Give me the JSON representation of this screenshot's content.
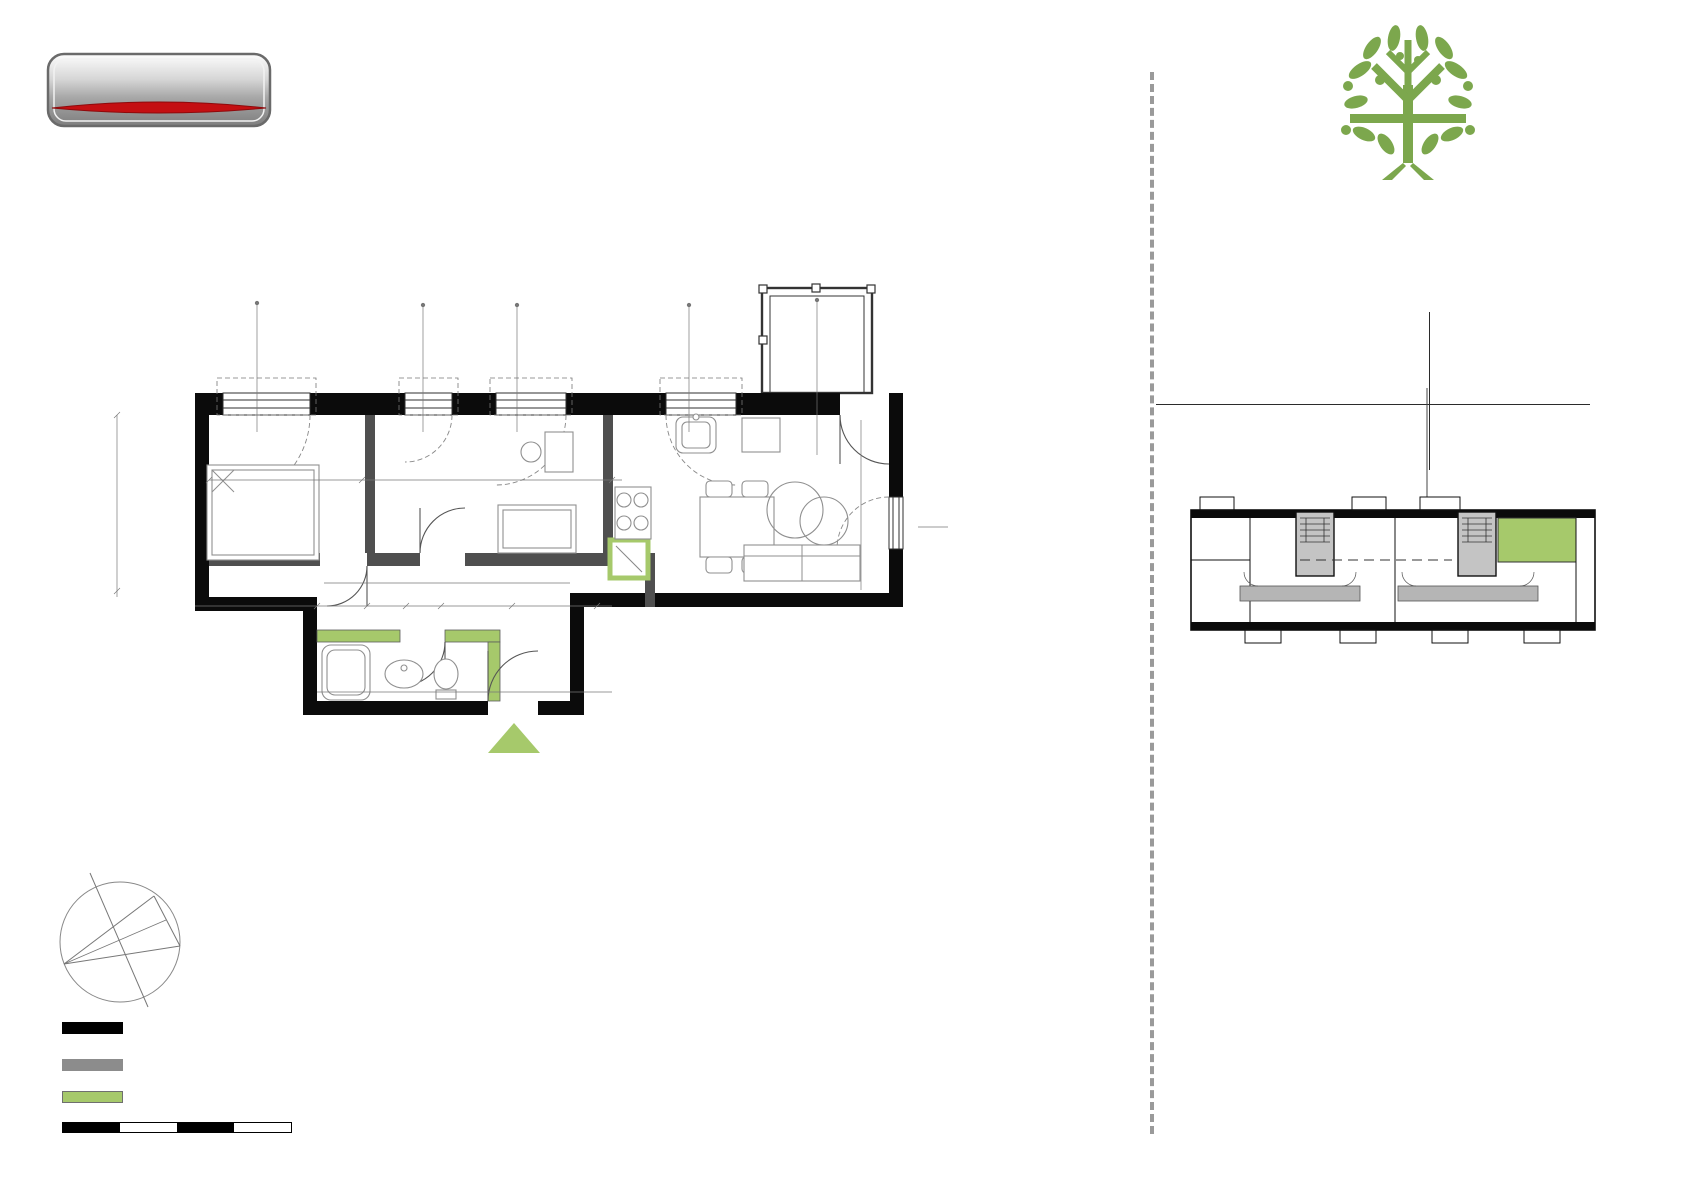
{
  "colors": {
    "green": "#7CA74D",
    "plan-green": "#A6C96B"
  },
  "developer": {
    "logo_text": "CENTRUM ZANA",
    "name": "Centrum Zana G.Turski M. Balcerek",
    "line2": "Spółka komandytowa",
    "line3": "ul. Nałęczowska 14,",
    "line4": "20-701 Lublin"
  },
  "project": {
    "name_top": "SNOPKÓW",
    "name_bottom": "PARK",
    "apartment": "MIESZKANIE NR 11",
    "building": "Budynek B10"
  },
  "details": {
    "typ_label": "TYP:",
    "typ_bold": "trzy",
    "typ_rest1": "pokojowe z",
    "typ_rest2": "aneksem kuchennym",
    "area_label": "POWIERZCHNIA:",
    "area_value": "59,34 m",
    "area_sup": "2",
    "floor_label": "KONDYGNACJA:",
    "floor_value": "piętro +2",
    "height_label": "WYSOKOŚĆ:",
    "height_value": "2,55 m"
  },
  "rooms": {
    "header": "WYKAZ POMIESZCZEŃ:",
    "unit_sup": "2",
    "items": [
      {
        "no": "1",
        "name": "przedpokój",
        "area": "9,02 m"
      },
      {
        "no": "2",
        "name": "salon z aneksem",
        "area": "22,86 m"
      },
      {
        "no": "3",
        "name": "pokój",
        "area": "10,44 m"
      },
      {
        "no": "4",
        "name": "pokój",
        "area": "10,85 m"
      },
      {
        "no": "5",
        "name": "łazienka",
        "area": "5,19 m"
      }
    ],
    "extra": [
      {
        "no": "",
        "name": "balkon",
        "area": "2,76 m"
      }
    ],
    "demontaz_line1": "Powierzchnia pod ścianami",
    "demontaz_line2": "nadającymi się do demontażu",
    "demontaz_value": "0,98 m"
  },
  "sales": {
    "label": "Biuro sprzedaży:",
    "line1": "Lublin ul. Nałęczowska 14, XIII piętro",
    "line2": "tel. 605 881 004, (81) 528 93 11",
    "line3": "email: aw@zana.pl"
  },
  "legend": {
    "item1_line1": "ściana zewnętrzna / konstrukcyjna -",
    "item1_line2": "prefabrykowana",
    "item2_line1": "ściana wewnętrzna / działowa",
    "item2_line2": "nadająca się do demontażu",
    "item3_line1": "ściana wewnętrzna"
  },
  "notes": {
    "header": "Uwagi:",
    "line1": "1. Podane wymiary są orientacyjne i mogą odbiegać od",
    "line2": "rzeczywistych.",
    "line3": "2. Aranżacja lokalu przedstawiona na rzucie jest przykładowa."
  },
  "scalebar": {
    "labels": [
      "0",
      "1",
      "2",
      "3",
      "4m"
    ]
  },
  "compass": {
    "label": "Z"
  },
  "floorplan": {
    "room_labels": [
      {
        "t": "4",
        "x": 277,
        "y": 503
      },
      {
        "t": "3",
        "x": 489,
        "y": 500
      },
      {
        "t": "2",
        "x": 791,
        "y": 503
      },
      {
        "t": "1",
        "x": 545,
        "y": 645
      },
      {
        "t": "5",
        "x": 399,
        "y": 676
      }
    ],
    "dim_labels": [
      {
        "t": "150",
        "x": 247,
        "y": 352,
        "r": 1
      },
      {
        "t": "150",
        "x": 266,
        "y": 352,
        "r": 1
      },
      {
        "t": "80",
        "x": 413,
        "y": 354,
        "r": 1
      },
      {
        "t": "150",
        "x": 432,
        "y": 354,
        "r": 1
      },
      {
        "t": "121",
        "x": 507,
        "y": 355,
        "r": 1
      },
      {
        "t": "150",
        "x": 526,
        "y": 355,
        "r": 1
      },
      {
        "t": "121",
        "x": 679,
        "y": 355,
        "r": 1
      },
      {
        "t": "150",
        "x": 698,
        "y": 355,
        "r": 1
      },
      {
        "t": "100",
        "x": 807,
        "y": 341,
        "r": 1
      },
      {
        "t": "235",
        "x": 826,
        "y": 341,
        "r": 1
      },
      {
        "t": "hp= 90",
        "x": 252,
        "y": 430
      },
      {
        "t": "hp= 90",
        "x": 414,
        "y": 430
      },
      {
        "t": "hp= 90",
        "x": 521,
        "y": 430
      },
      {
        "t": "hp= 90",
        "x": 661,
        "y": 430
      },
      {
        "t": "hp= 90",
        "x": 897,
        "y": 531,
        "r": 1
      },
      {
        "t": "121",
        "x": 932,
        "y": 517
      },
      {
        "t": "150",
        "x": 932,
        "y": 539
      },
      {
        "t": "285",
        "x": 281,
        "y": 477
      },
      {
        "t": "8",
        "x": 357,
        "y": 477
      },
      {
        "t": "419",
        "x": 480,
        "y": 477
      },
      {
        "t": "10",
        "x": 597,
        "y": 452
      },
      {
        "t": "597",
        "x": 791,
        "y": 452
      },
      {
        "t": "597",
        "x": 737,
        "y": 588
      },
      {
        "t": "381",
        "x": 112,
        "y": 497,
        "r": 1
      },
      {
        "t": "389",
        "x": 860,
        "y": 497,
        "r": 1
      },
      {
        "t": "249",
        "x": 384,
        "y": 476,
        "r": 1
      },
      {
        "t": "249",
        "x": 592,
        "y": 478,
        "r": 1
      },
      {
        "t": "215",
        "x": 659,
        "y": 470,
        "r": 1
      },
      {
        "t": "54",
        "x": 629,
        "y": 522
      },
      {
        "t": "66",
        "x": 657,
        "y": 559,
        "r": 1
      },
      {
        "t": "8",
        "x": 590,
        "y": 549,
        "r": 1
      },
      {
        "t": "36",
        "x": 590,
        "y": 578,
        "r": 1
      },
      {
        "t": "80",
        "x": 344,
        "y": 577
      },
      {
        "t": "200",
        "x": 344,
        "y": 590
      },
      {
        "t": "80",
        "x": 436,
        "y": 532,
        "r": 1
      },
      {
        "t": "200",
        "x": 450,
        "y": 532,
        "r": 1
      },
      {
        "t": "125",
        "x": 383,
        "y": 592,
        "r": 1
      },
      {
        "t": "419",
        "x": 489,
        "y": 586
      },
      {
        "t": "125",
        "x": 519,
        "y": 592,
        "r": 1
      },
      {
        "t": "+200",
        "x": 483,
        "y": 601
      },
      {
        "t": "90",
        "x": 403,
        "y": 622,
        "r": 1
      },
      {
        "t": "200",
        "x": 417,
        "y": 622,
        "r": 1
      },
      {
        "t": "208",
        "x": 262,
        "y": 620
      },
      {
        "t": "77",
        "x": 347,
        "y": 610
      },
      {
        "t": "44",
        "x": 386,
        "y": 610
      },
      {
        "t": "90",
        "x": 424,
        "y": 610
      },
      {
        "t": "101",
        "x": 475,
        "y": 610
      },
      {
        "t": "183",
        "x": 556,
        "y": 610
      },
      {
        "t": "90",
        "x": 588,
        "y": 610,
        "r": 1
      },
      {
        "t": "10",
        "x": 602,
        "y": 610
      },
      {
        "t": "80",
        "x": 621,
        "y": 598
      },
      {
        "t": "302",
        "x": 412,
        "y": 649
      },
      {
        "t": "162",
        "x": 331,
        "y": 673,
        "r": 1
      },
      {
        "t": "197",
        "x": 478,
        "y": 686,
        "r": 1
      },
      {
        "t": "207",
        "x": 521,
        "y": 686,
        "r": 1
      },
      {
        "t": "183",
        "x": 556,
        "y": 672
      },
      {
        "t": "206",
        "x": 592,
        "y": 672,
        "r": 1
      },
      {
        "t": "163",
        "x": 341,
        "y": 696
      },
      {
        "t": "58",
        "x": 428,
        "y": 696
      },
      {
        "t": "81",
        "x": 468,
        "y": 696
      },
      {
        "t": "10",
        "x": 495,
        "y": 696
      },
      {
        "t": "107",
        "x": 549,
        "y": 696
      },
      {
        "t": "58",
        "x": 591,
        "y": 696
      },
      {
        "t": "90",
        "x": 492,
        "y": 732,
        "r": 1
      },
      {
        "t": "200",
        "x": 506,
        "y": 732,
        "r": 1
      },
      {
        "t": "F",
        "x": 760,
        "y": 441,
        "s": 13
      }
    ]
  }
}
